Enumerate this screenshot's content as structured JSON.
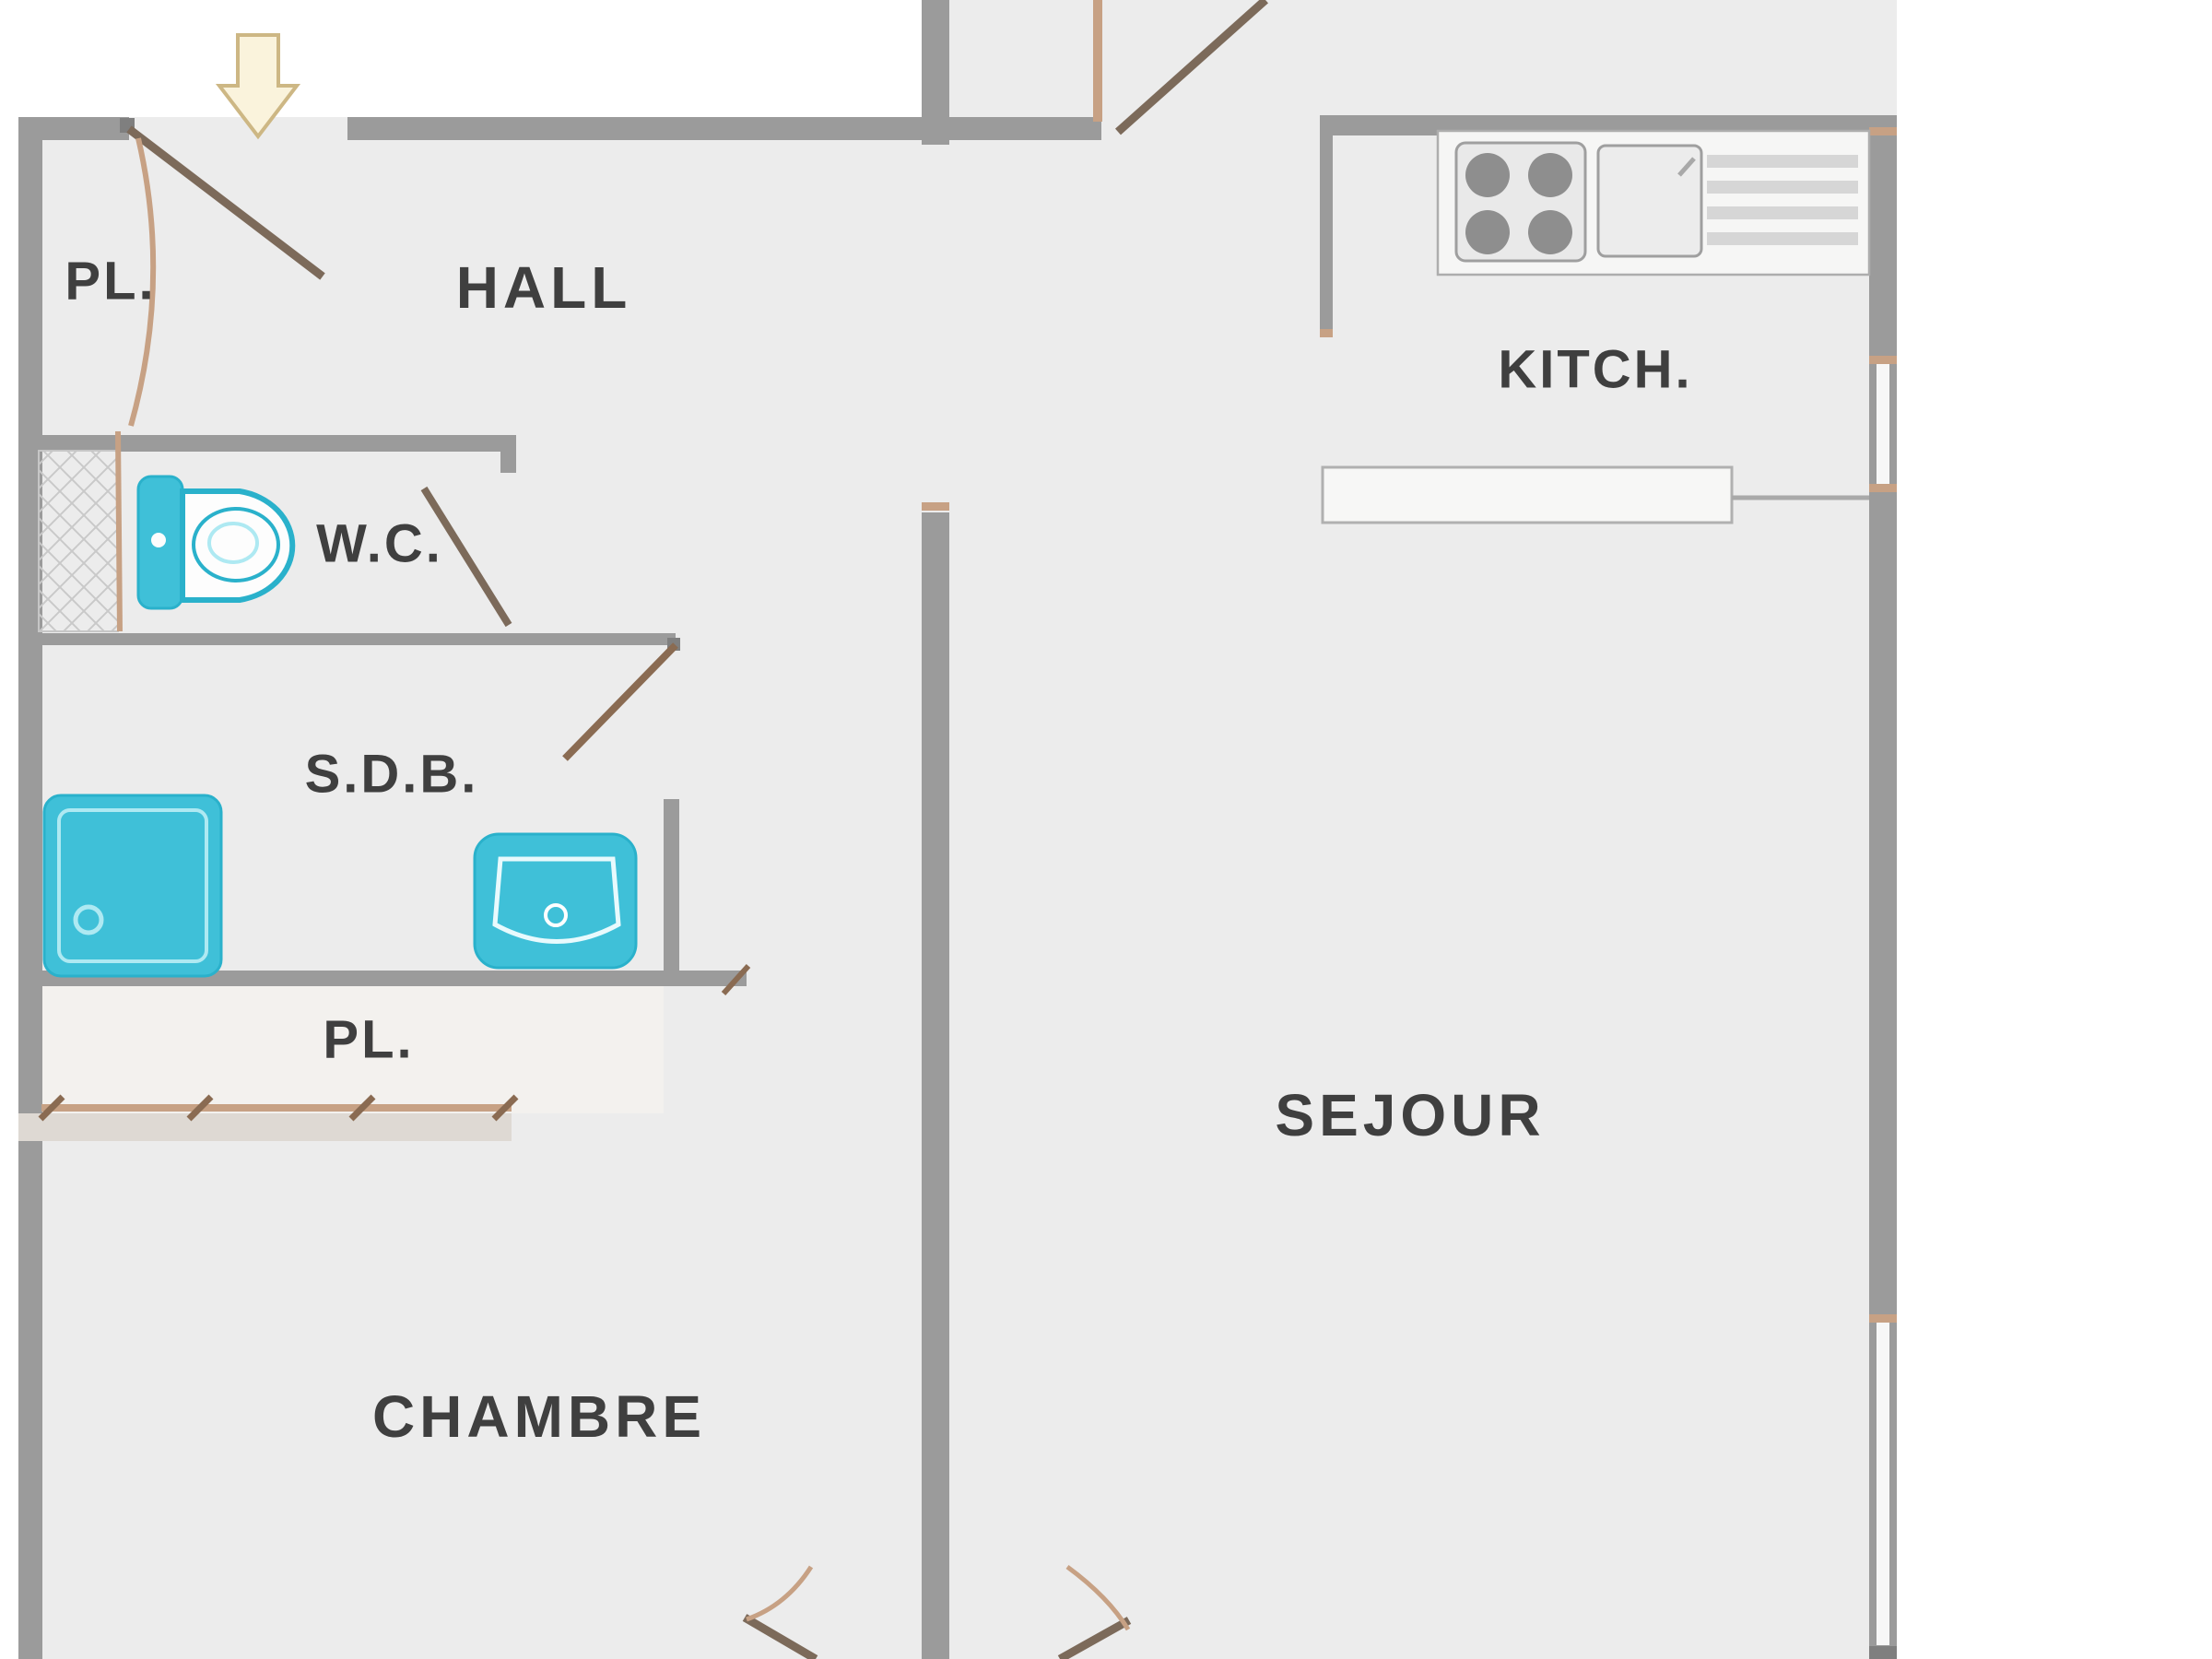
{
  "title": "Apartment floor plan (French)",
  "labels": {
    "pl_top": "PL.",
    "hall": "HALL",
    "wc": "W.C.",
    "sdb": "S.D.B.",
    "pl_bottom": "PL.",
    "chambre": "CHAMBRE",
    "kitchen": "KITCH.",
    "sejour": "SEJOUR"
  },
  "icons": {
    "entrance_arrow": "down-arrow entrance marker",
    "toilet": "toilet top view",
    "shower": "shower tray top view",
    "washbasin": "washbasin top view",
    "stove": "4-burner cooktop top view",
    "kitchen_sink": "kitchen sink with drainboard top view",
    "duct_shaft": "cross-hatched duct shaft"
  },
  "colors": {
    "floor": "#ececec",
    "outside": "#ffffff",
    "wall": "#9b9b9b",
    "text": "#3f3f3f",
    "fixture": "#3fc0d8",
    "fixture_stroke": "#2ab1cb",
    "door_arc": "#c7a184",
    "door_leaf": "#7c6a5a",
    "arrow_fill": "#faf3dc",
    "arrow_stroke": "#cdb784",
    "appliance": "#8e8e8e"
  }
}
